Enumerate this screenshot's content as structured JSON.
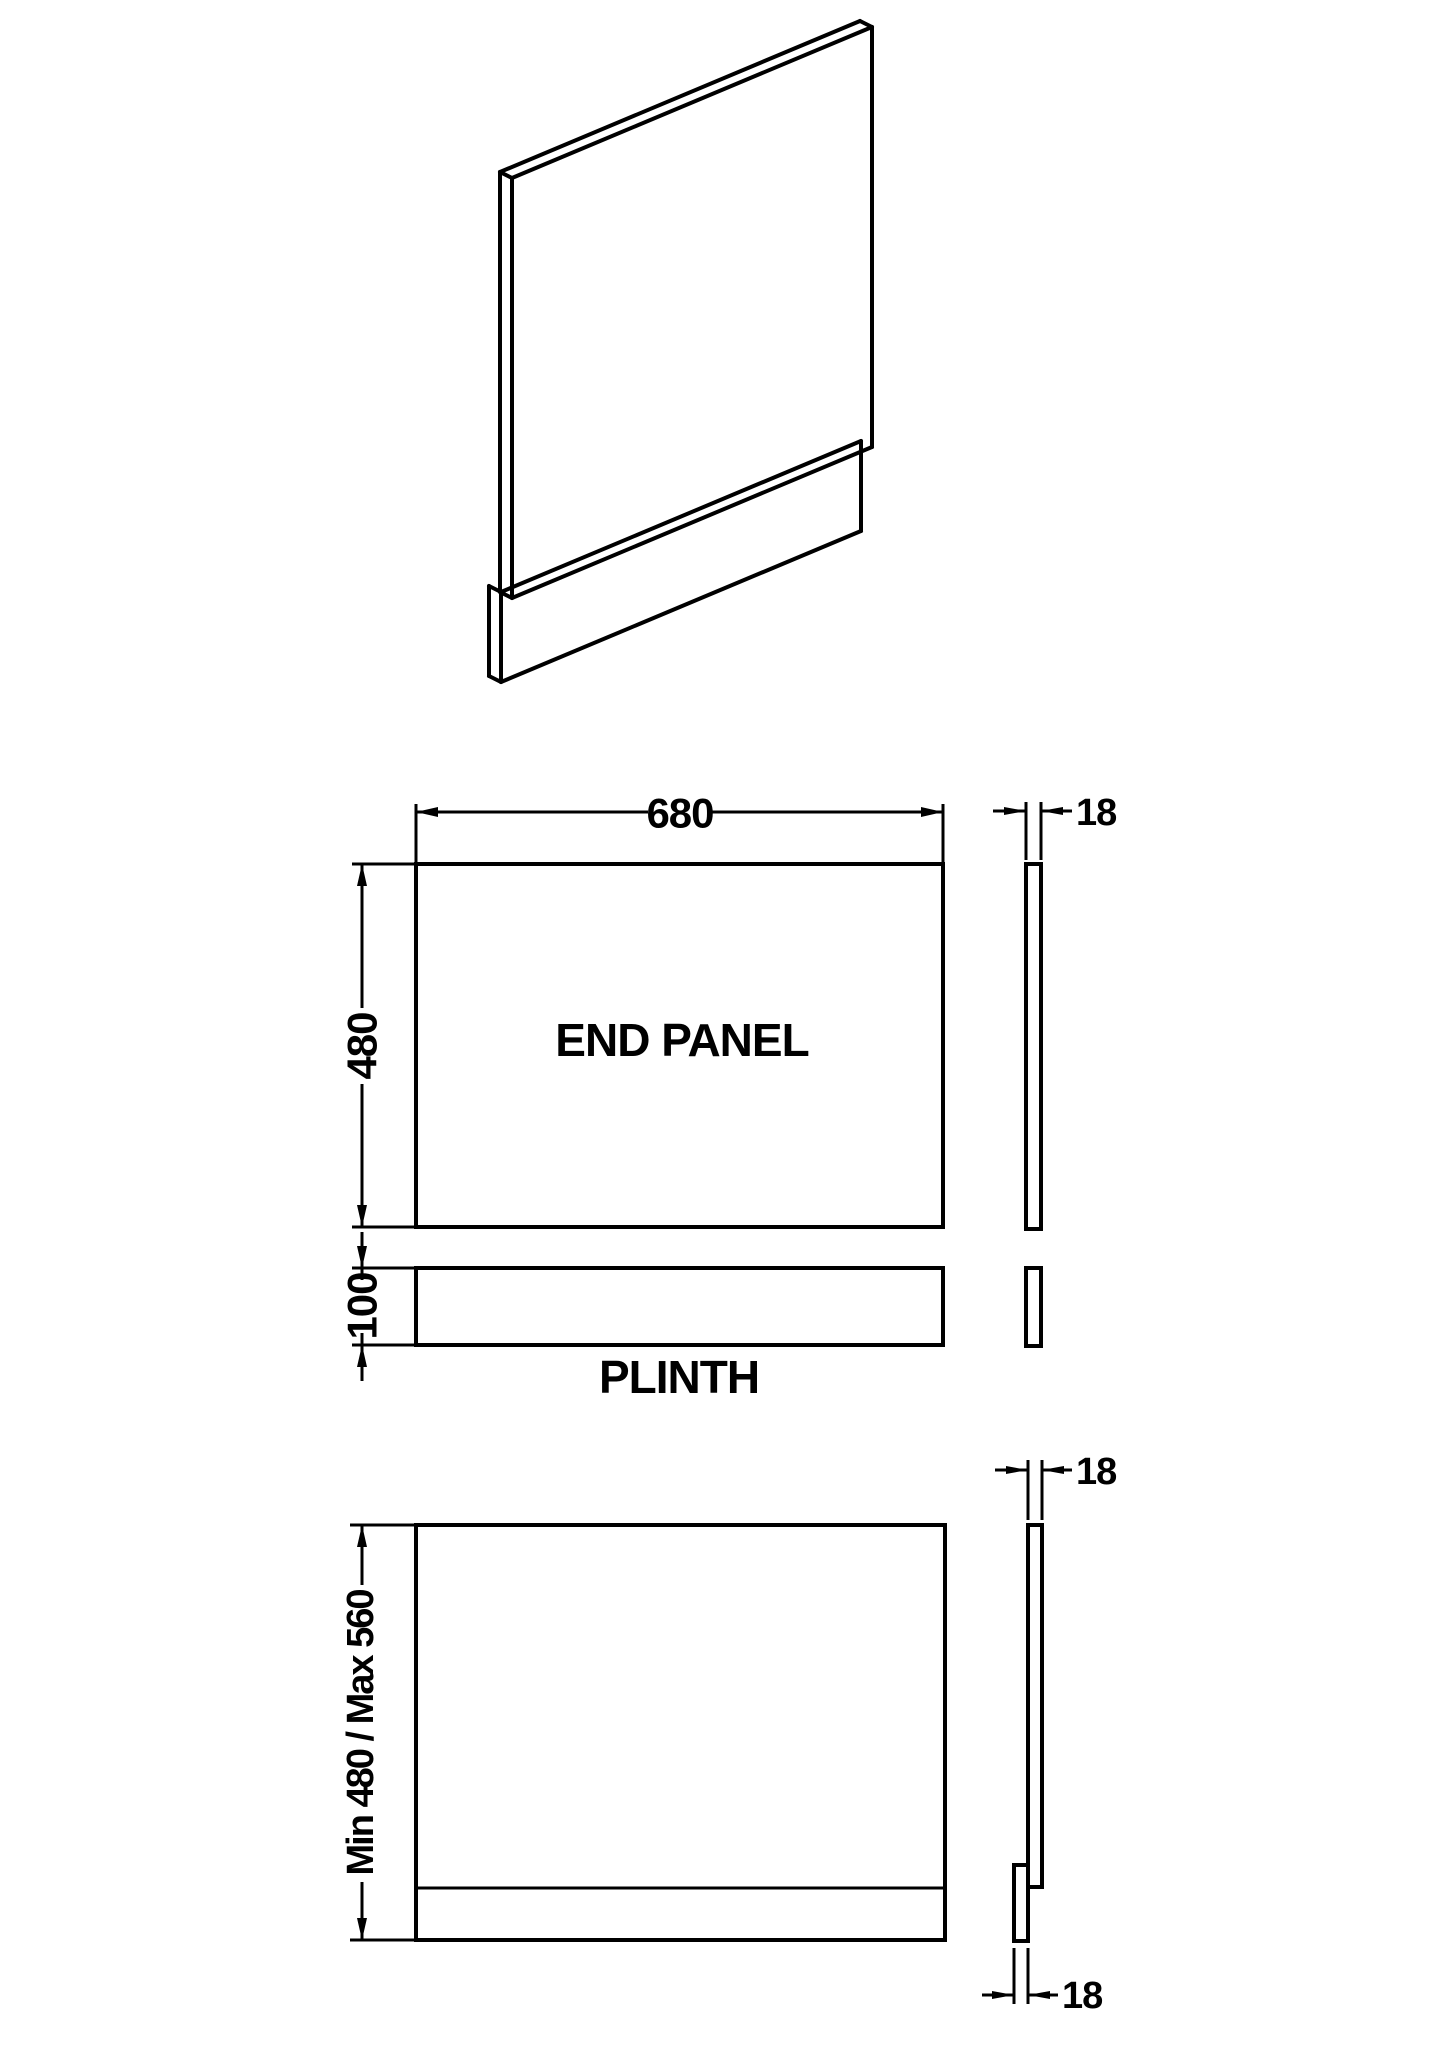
{
  "page": {
    "background": "#ffffff",
    "line_color": "#000000"
  },
  "views": {
    "end_panel_label": "END PANEL",
    "plinth_label": "PLINTH"
  },
  "dimensions": {
    "panel_width": "680",
    "panel_height": "480",
    "panel_thickness": "18",
    "plinth_height": "100",
    "overall_height_range": "Min 480 / Max 560",
    "bottom_panel_thickness": "18",
    "bottom_plinth_thickness": "18"
  }
}
